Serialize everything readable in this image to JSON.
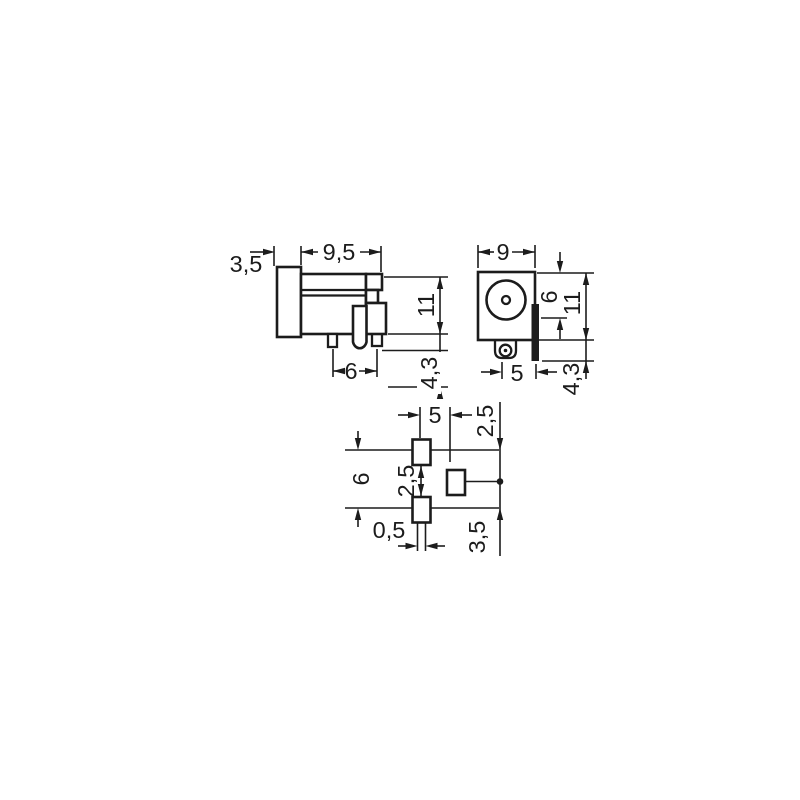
{
  "title": "connector-dimension-drawing",
  "colors": {
    "background": "#ffffff",
    "ink": "#1c1c1c"
  },
  "labels": {
    "side": {
      "flange_depth": "3,5",
      "body_depth": "9,5",
      "height": "11",
      "pin_spacing": "6",
      "pin_protrusion": "4,3"
    },
    "front": {
      "width": "9",
      "barrel_diameter": "6",
      "height": "11",
      "pin_offset": "5",
      "tab_protrusion": "4,3"
    },
    "footprint": {
      "pad_span": "5",
      "upper_row_offset": "2,5",
      "column_height": "6",
      "pad_gap": "2,5",
      "slot_width": "0,5",
      "lower_row_offset": "3,5"
    }
  }
}
